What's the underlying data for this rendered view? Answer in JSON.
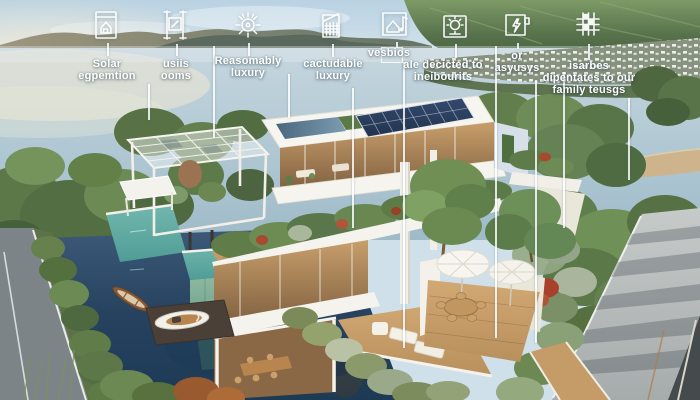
{
  "callouts": [
    {
      "icon": "blueprint-house-icon",
      "lines": [
        "Solar",
        "egpemtion"
      ]
    },
    {
      "icon": "window-frame-icon",
      "lines": [
        "usiis",
        "ooms"
      ]
    },
    {
      "icon": "gear-sun-icon",
      "lines": [
        "Reasomably",
        "luxury"
      ]
    },
    {
      "icon": "building-facade-icon",
      "lines": [
        "cactudable",
        "luxury"
      ]
    },
    {
      "icon": "house-music-note-icon",
      "lines": [
        "vesbios"
      ]
    },
    {
      "icon": "sun-photo-icon",
      "lines": [
        "ale decicted to",
        "ineibourits"
      ]
    },
    {
      "icon": "lightning-frame-icon",
      "lines": [
        "or",
        "asyusys"
      ]
    },
    {
      "icon": "grid-blocks-icon",
      "lines": [
        "isarbes",
        "dipentates to our",
        "family teusgs"
      ]
    }
  ],
  "colors": {
    "sky": "#c9dbe7",
    "bay_water": "#aec5d1",
    "lake_water": "#2a4763",
    "foliage": "#617e4c",
    "house_white": "#f5f3ee",
    "wood": "#c39a66",
    "solar_panel": "#2c3f5f",
    "pool_water": "#5aa69e",
    "pool_wall": "#8abf9f",
    "road_light": "#b4b9ba",
    "road_dark": "#45494c",
    "label_text": "#ffffff"
  }
}
